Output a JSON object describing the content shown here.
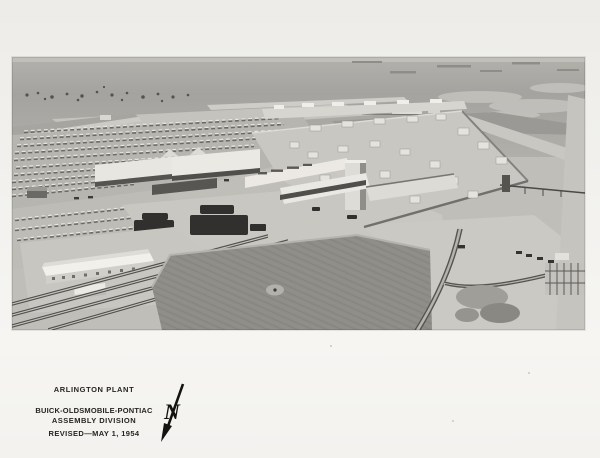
{
  "page": {
    "background_color": "#f2f1ee",
    "ink_color": "#262523"
  },
  "photo": {
    "alt": "aerial-photograph-of-assembly-plant",
    "tone_light": "#c9c7c2",
    "tone_dark": "#4c4b48",
    "field_tone": "#8e8d88"
  },
  "caption": {
    "line1": "ARLINGTON PLANT",
    "line2": "BUICK-OLDSMOBILE-PONTIAC",
    "line3": "ASSEMBLY DIVISION",
    "line4": "REVISED—MAY 1, 1954"
  },
  "north_arrow": {
    "label": "N"
  }
}
